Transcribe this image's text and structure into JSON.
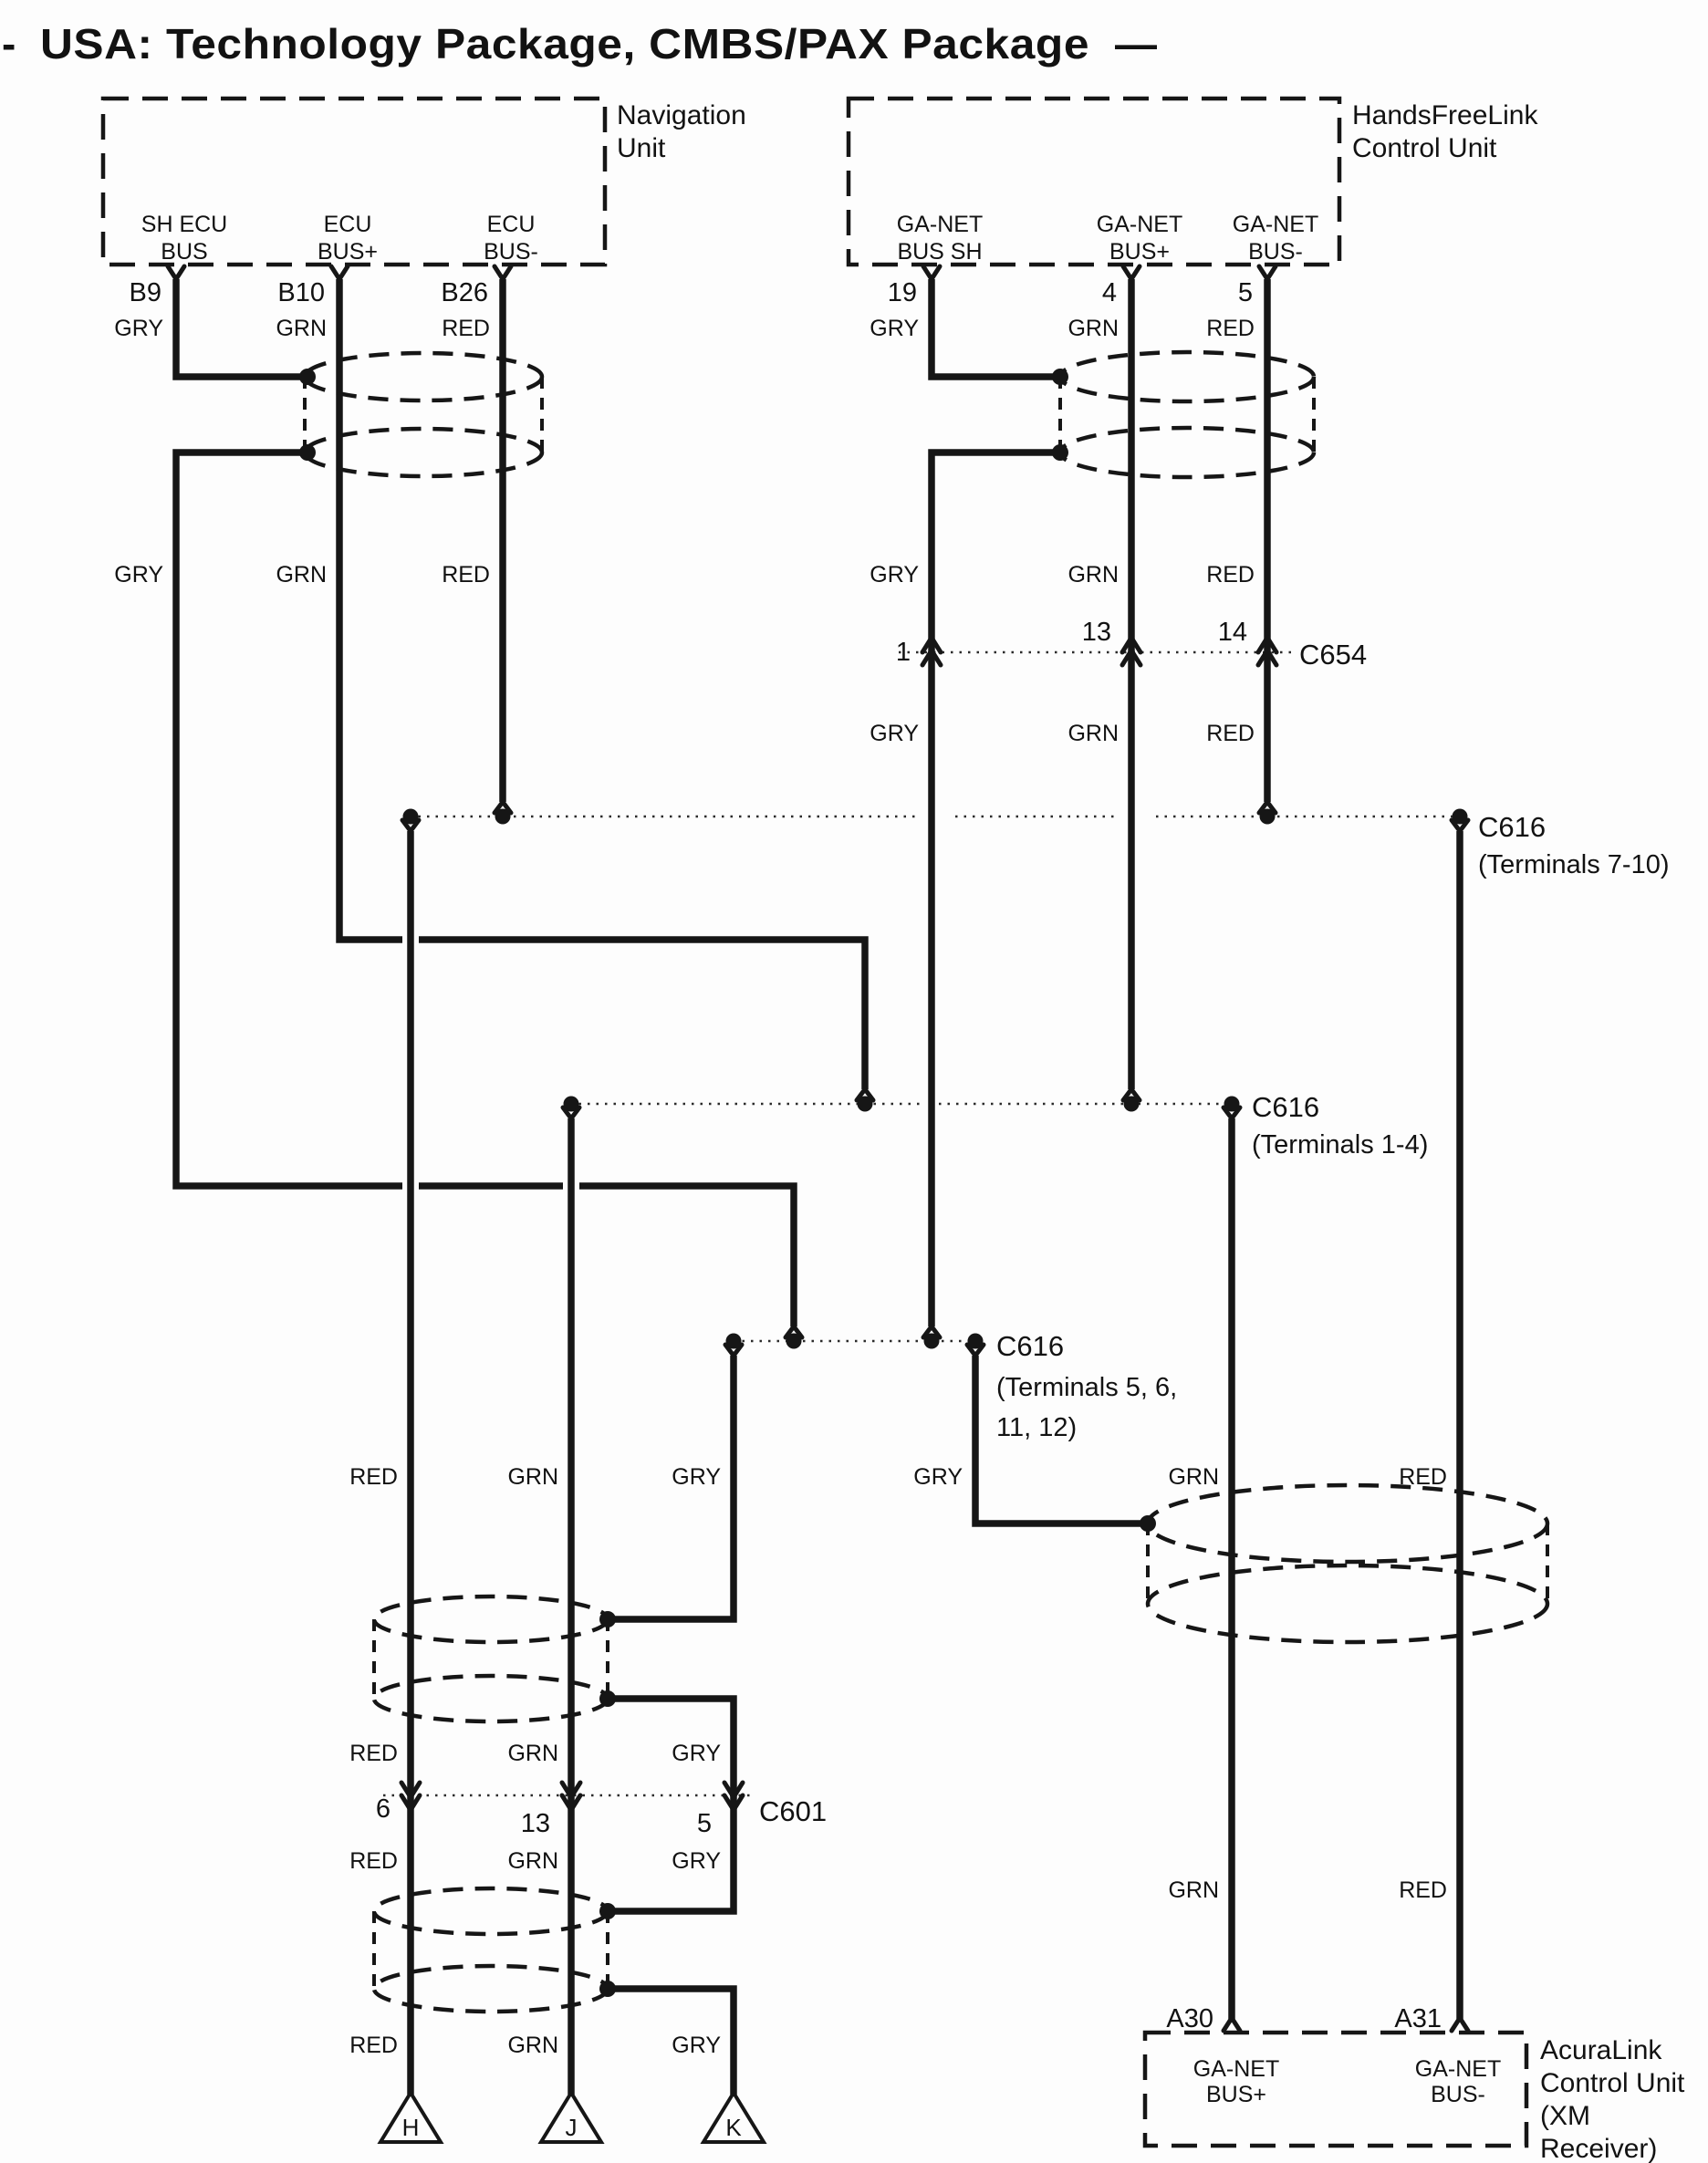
{
  "title": {
    "prefix": "-",
    "main": "USA: Technology Package, CMBS/PAX Package",
    "suffix": "—"
  },
  "colors": {
    "gry": "GRY",
    "grn": "GRN",
    "red": "RED"
  },
  "units": {
    "navigation": {
      "name": [
        "Navigation",
        "Unit"
      ],
      "pins": [
        {
          "id": "B9",
          "bus": [
            "SH ECU",
            "BUS"
          ],
          "wire_color": "GRY"
        },
        {
          "id": "B10",
          "bus": [
            "ECU",
            "BUS+"
          ],
          "wire_color": "GRN"
        },
        {
          "id": "B26",
          "bus": [
            "ECU",
            "BUS-"
          ],
          "wire_color": "RED"
        }
      ]
    },
    "handsfreelink": {
      "name": [
        "HandsFreeLink",
        "Control Unit"
      ],
      "pins": [
        {
          "id": "19",
          "bus": [
            "GA-NET",
            "BUS SH"
          ],
          "wire_color": "GRY"
        },
        {
          "id": "4",
          "bus": [
            "GA-NET",
            "BUS+"
          ],
          "wire_color": "GRN"
        },
        {
          "id": "5",
          "bus": [
            "GA-NET",
            "BUS-"
          ],
          "wire_color": "RED"
        }
      ]
    },
    "acuralink": {
      "name": [
        "AcuraLink",
        "Control Unit",
        "(XM",
        "Receiver)"
      ],
      "pins": [
        {
          "id": "A30",
          "bus": [
            "GA-NET",
            "BUS+"
          ],
          "wire_color": "GRN"
        },
        {
          "id": "A31",
          "bus": [
            "GA-NET",
            "BUS-"
          ],
          "wire_color": "RED"
        }
      ]
    }
  },
  "connectors": {
    "c654": {
      "name": "C654",
      "pin_numbers": [
        "1",
        "13",
        "14"
      ]
    },
    "c601": {
      "name": "C601",
      "pin_numbers": [
        "6",
        "13",
        "5"
      ]
    },
    "c616_red": {
      "name": "C616",
      "terminals": "(Terminals 7-10)"
    },
    "c616_grn": {
      "name": "C616",
      "terminals": "(Terminals 1-4)"
    },
    "c616_gry": {
      "name": "C616",
      "terminals": [
        "(Terminals 5, 6,",
        "11, 12)"
      ]
    }
  },
  "ground_triangles": [
    "H",
    "J",
    "K"
  ]
}
